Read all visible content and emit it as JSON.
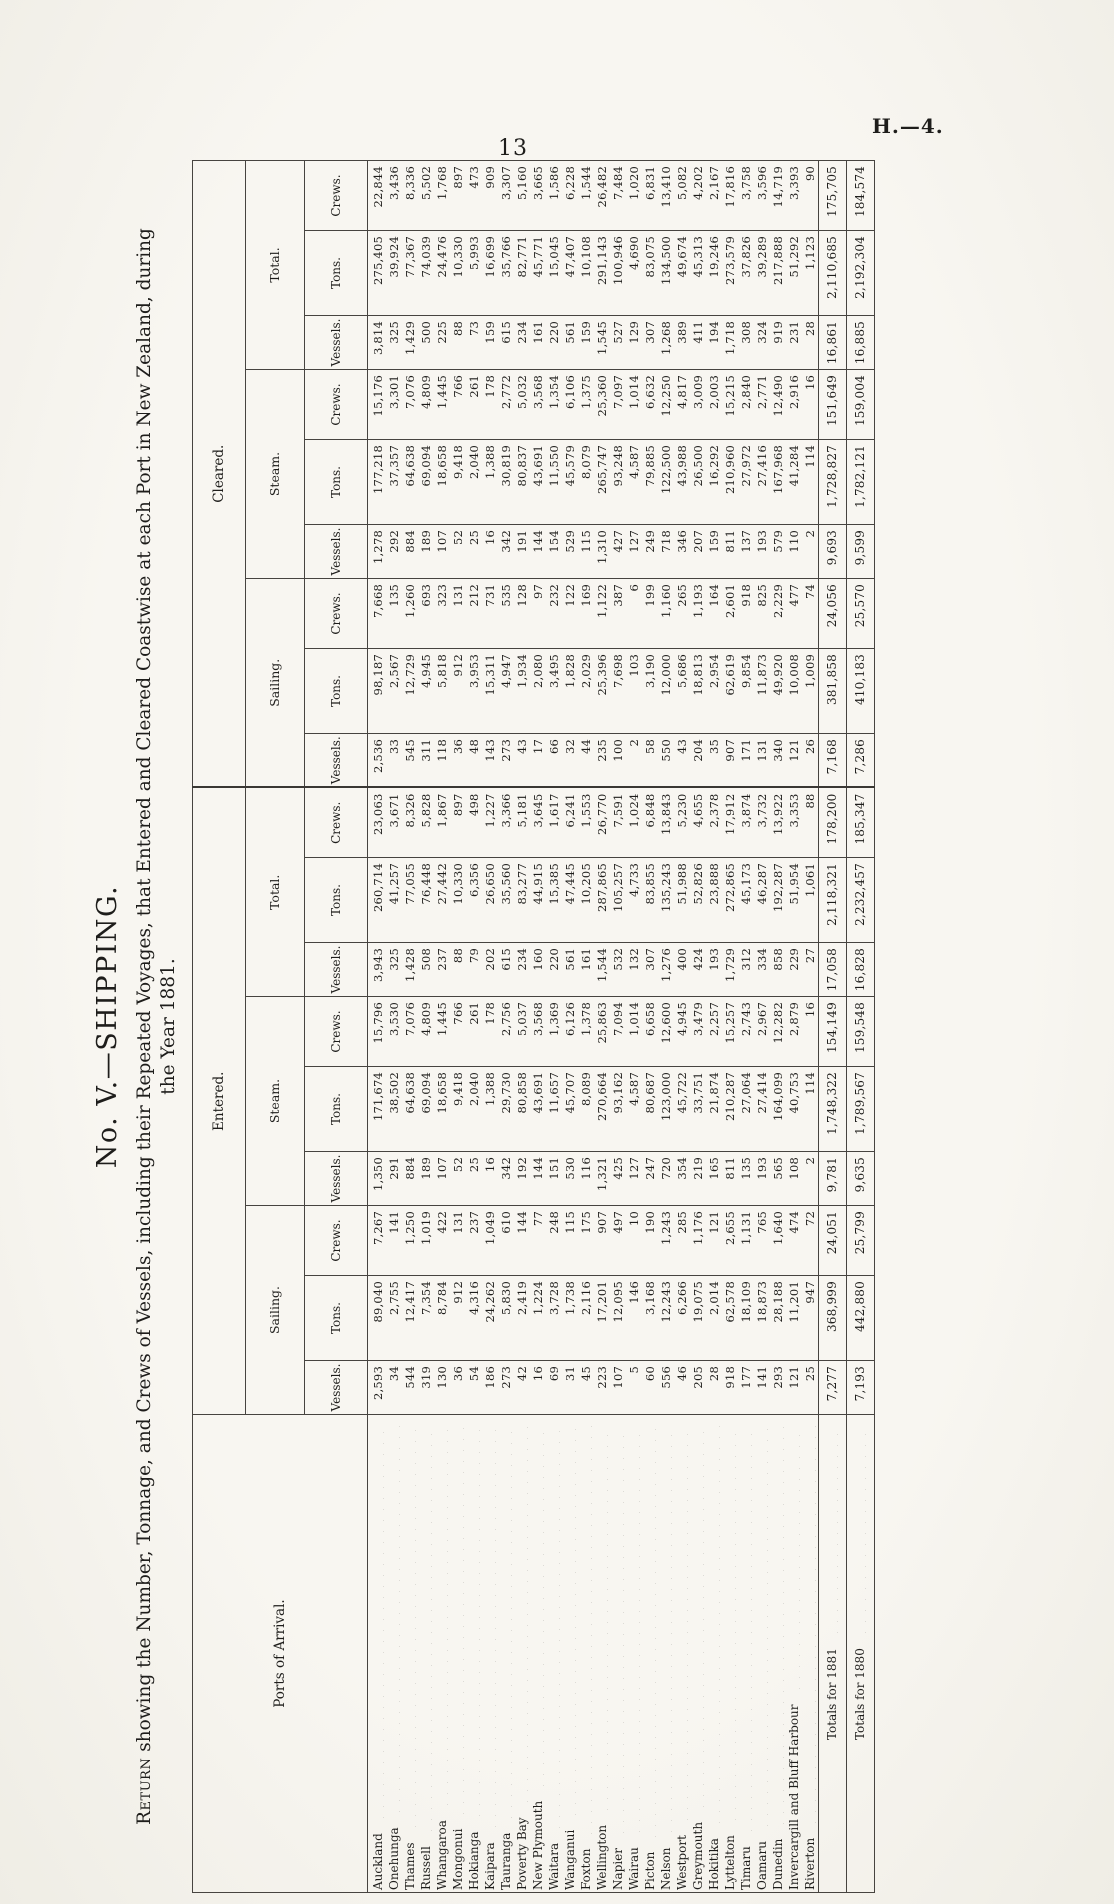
{
  "page": {
    "number": "13",
    "folio": "H.—4."
  },
  "title": "No. V.—SHIPPING.",
  "subtitle": {
    "lead": "Return",
    "rest": " showing the Number, Tonnage, and Crews of Vessels, including their Repeated Voyages, that Entered and Cleared Coastwise at each Port in New Zealand, during",
    "line2": "the Year 1881."
  },
  "table": {
    "ports_header": "Ports of Arrival.",
    "groups": [
      "Entered.",
      "Cleared."
    ],
    "subgroups": [
      "Sailing.",
      "Steam.",
      "Total."
    ],
    "columns": [
      "Vessels.",
      "Tons.",
      "Crews."
    ],
    "rows": [
      {
        "port": "Auckland",
        "values": [
          "2,593",
          "89,040",
          "7,267",
          "1,350",
          "171,674",
          "15,796",
          "3,943",
          "260,714",
          "23,063",
          "2,536",
          "98,187",
          "7,668",
          "1,278",
          "177,218",
          "15,176",
          "3,814",
          "275,405",
          "22,844"
        ]
      },
      {
        "port": "Onehunga",
        "values": [
          "34",
          "2,755",
          "141",
          "291",
          "38,502",
          "3,530",
          "325",
          "41,257",
          "3,671",
          "33",
          "2,567",
          "135",
          "292",
          "37,357",
          "3,301",
          "325",
          "39,924",
          "3,436"
        ]
      },
      {
        "port": "Thames",
        "values": [
          "544",
          "12,417",
          "1,250",
          "884",
          "64,638",
          "7,076",
          "1,428",
          "77,055",
          "8,326",
          "545",
          "12,729",
          "1,260",
          "884",
          "64,638",
          "7,076",
          "1,429",
          "77,367",
          "8,336"
        ]
      },
      {
        "port": "Russell",
        "values": [
          "319",
          "7,354",
          "1,019",
          "189",
          "69,094",
          "4,809",
          "508",
          "76,448",
          "5,828",
          "311",
          "4,945",
          "693",
          "189",
          "69,094",
          "4,809",
          "500",
          "74,039",
          "5,502"
        ]
      },
      {
        "port": "Whangaroa",
        "values": [
          "130",
          "8,784",
          "422",
          "107",
          "18,658",
          "1,445",
          "237",
          "27,442",
          "1,867",
          "118",
          "5,818",
          "323",
          "107",
          "18,658",
          "1,445",
          "225",
          "24,476",
          "1,768"
        ]
      },
      {
        "port": "Mongonui",
        "values": [
          "36",
          "912",
          "131",
          "52",
          "9,418",
          "766",
          "88",
          "10,330",
          "897",
          "36",
          "912",
          "131",
          "52",
          "9,418",
          "766",
          "88",
          "10,330",
          "897"
        ]
      },
      {
        "port": "Hokianga",
        "values": [
          "54",
          "4,316",
          "237",
          "25",
          "2,040",
          "261",
          "79",
          "6,356",
          "498",
          "48",
          "3,953",
          "212",
          "25",
          "2,040",
          "261",
          "73",
          "5,993",
          "473"
        ]
      },
      {
        "port": "Kaipara",
        "values": [
          "186",
          "24,262",
          "1,049",
          "16",
          "1,388",
          "178",
          "202",
          "26,650",
          "1,227",
          "143",
          "15,311",
          "731",
          "16",
          "1,388",
          "178",
          "159",
          "16,699",
          "909"
        ]
      },
      {
        "port": "Tauranga",
        "values": [
          "273",
          "5,830",
          "610",
          "342",
          "29,730",
          "2,756",
          "615",
          "35,560",
          "3,366",
          "273",
          "4,947",
          "535",
          "342",
          "30,819",
          "2,772",
          "615",
          "35,766",
          "3,307"
        ]
      },
      {
        "port": "Poverty Bay",
        "values": [
          "42",
          "2,419",
          "144",
          "192",
          "80,858",
          "5,037",
          "234",
          "83,277",
          "5,181",
          "43",
          "1,934",
          "128",
          "191",
          "80,837",
          "5,032",
          "234",
          "82,771",
          "5,160"
        ]
      },
      {
        "port": "New Plymouth",
        "values": [
          "16",
          "1,224",
          "77",
          "144",
          "43,691",
          "3,568",
          "160",
          "44,915",
          "3,645",
          "17",
          "2,080",
          "97",
          "144",
          "43,691",
          "3,568",
          "161",
          "45,771",
          "3,665"
        ]
      },
      {
        "port": "Waitara",
        "values": [
          "69",
          "3,728",
          "248",
          "151",
          "11,657",
          "1,369",
          "220",
          "15,385",
          "1,617",
          "66",
          "3,495",
          "232",
          "154",
          "11,550",
          "1,354",
          "220",
          "15,045",
          "1,586"
        ]
      },
      {
        "port": "Wanganui",
        "values": [
          "31",
          "1,738",
          "115",
          "530",
          "45,707",
          "6,126",
          "561",
          "47,445",
          "6,241",
          "32",
          "1,828",
          "122",
          "529",
          "45,579",
          "6,106",
          "561",
          "47,407",
          "6,228"
        ]
      },
      {
        "port": "Foxton",
        "values": [
          "45",
          "2,116",
          "175",
          "116",
          "8,089",
          "1,378",
          "161",
          "10,205",
          "1,553",
          "44",
          "2,029",
          "169",
          "115",
          "8,079",
          "1,375",
          "159",
          "10,108",
          "1,544"
        ]
      },
      {
        "port": "Wellington",
        "values": [
          "223",
          "17,201",
          "907",
          "1,321",
          "270,664",
          "25,863",
          "1,544",
          "287,865",
          "26,770",
          "235",
          "25,396",
          "1,122",
          "1,310",
          "265,747",
          "25,360",
          "1,545",
          "291,143",
          "26,482"
        ]
      },
      {
        "port": "Napier",
        "values": [
          "107",
          "12,095",
          "497",
          "425",
          "93,162",
          "7,094",
          "532",
          "105,257",
          "7,591",
          "100",
          "7,698",
          "387",
          "427",
          "93,248",
          "7,097",
          "527",
          "100,946",
          "7,484"
        ]
      },
      {
        "port": "Wairau",
        "values": [
          "5",
          "146",
          "10",
          "127",
          "4,587",
          "1,014",
          "132",
          "4,733",
          "1,024",
          "2",
          "103",
          "6",
          "127",
          "4,587",
          "1,014",
          "129",
          "4,690",
          "1,020"
        ]
      },
      {
        "port": "Picton",
        "values": [
          "60",
          "3,168",
          "190",
          "247",
          "80,687",
          "6,658",
          "307",
          "83,855",
          "6,848",
          "58",
          "3,190",
          "199",
          "249",
          "79,885",
          "6,632",
          "307",
          "83,075",
          "6,831"
        ]
      },
      {
        "port": "Nelson",
        "values": [
          "556",
          "12,243",
          "1,243",
          "720",
          "123,000",
          "12,600",
          "1,276",
          "135,243",
          "13,843",
          "550",
          "12,000",
          "1,160",
          "718",
          "122,500",
          "12,250",
          "1,268",
          "134,500",
          "13,410"
        ]
      },
      {
        "port": "Westport",
        "values": [
          "46",
          "6,266",
          "285",
          "354",
          "45,722",
          "4,945",
          "400",
          "51,988",
          "5,230",
          "43",
          "5,686",
          "265",
          "346",
          "43,988",
          "4,817",
          "389",
          "49,674",
          "5,082"
        ]
      },
      {
        "port": "Greymouth",
        "values": [
          "205",
          "19,075",
          "1,176",
          "219",
          "33,751",
          "3,479",
          "424",
          "52,826",
          "4,655",
          "204",
          "18,813",
          "1,193",
          "207",
          "26,500",
          "3,009",
          "411",
          "45,313",
          "4,202"
        ]
      },
      {
        "port": "Hokitika",
        "values": [
          "28",
          "2,014",
          "121",
          "165",
          "21,874",
          "2,257",
          "193",
          "23,888",
          "2,378",
          "35",
          "2,954",
          "164",
          "159",
          "16,292",
          "2,003",
          "194",
          "19,246",
          "2,167"
        ]
      },
      {
        "port": "Lyttelton",
        "values": [
          "918",
          "62,578",
          "2,655",
          "811",
          "210,287",
          "15,257",
          "1,729",
          "272,865",
          "17,912",
          "907",
          "62,619",
          "2,601",
          "811",
          "210,960",
          "15,215",
          "1,718",
          "273,579",
          "17,816"
        ]
      },
      {
        "port": "Timaru",
        "values": [
          "177",
          "18,109",
          "1,131",
          "135",
          "27,064",
          "2,743",
          "312",
          "45,173",
          "3,874",
          "171",
          "9,854",
          "918",
          "137",
          "27,972",
          "2,840",
          "308",
          "37,826",
          "3,758"
        ]
      },
      {
        "port": "Oamaru",
        "values": [
          "141",
          "18,873",
          "765",
          "193",
          "27,414",
          "2,967",
          "334",
          "46,287",
          "3,732",
          "131",
          "11,873",
          "825",
          "193",
          "27,416",
          "2,771",
          "324",
          "39,289",
          "3,596"
        ]
      },
      {
        "port": "Dunedin",
        "values": [
          "293",
          "28,188",
          "1,640",
          "565",
          "164,099",
          "12,282",
          "858",
          "192,287",
          "13,922",
          "340",
          "49,920",
          "2,229",
          "579",
          "167,968",
          "12,490",
          "919",
          "217,888",
          "14,719"
        ]
      },
      {
        "port": "Invercargill and Bluff Harbour",
        "values": [
          "121",
          "11,201",
          "474",
          "108",
          "40,753",
          "2,879",
          "229",
          "51,954",
          "3,353",
          "121",
          "10,008",
          "477",
          "110",
          "41,284",
          "2,916",
          "231",
          "51,292",
          "3,393"
        ]
      },
      {
        "port": "Riverton",
        "values": [
          "25",
          "947",
          "72",
          "2",
          "114",
          "16",
          "27",
          "1,061",
          "88",
          "26",
          "1,009",
          "74",
          "2",
          "114",
          "16",
          "28",
          "1,123",
          "90"
        ]
      }
    ],
    "totals": [
      {
        "label": "Totals for 1881",
        "values": [
          "7,277",
          "368,999",
          "24,051",
          "9,781",
          "1,748,322",
          "154,149",
          "17,058",
          "2,118,321",
          "178,200",
          "7,168",
          "381,858",
          "24,056",
          "9,693",
          "1,728,827",
          "151,649",
          "16,861",
          "2,110,685",
          "175,705"
        ]
      },
      {
        "label": "Totals for 1880",
        "values": [
          "7,193",
          "442,880",
          "25,799",
          "9,635",
          "1,789,567",
          "159,548",
          "16,828",
          "2,232,457",
          "185,347",
          "7,286",
          "410,183",
          "25,570",
          "9,599",
          "1,782,121",
          "159,004",
          "16,885",
          "2,192,304",
          "184,574"
        ]
      }
    ]
  }
}
